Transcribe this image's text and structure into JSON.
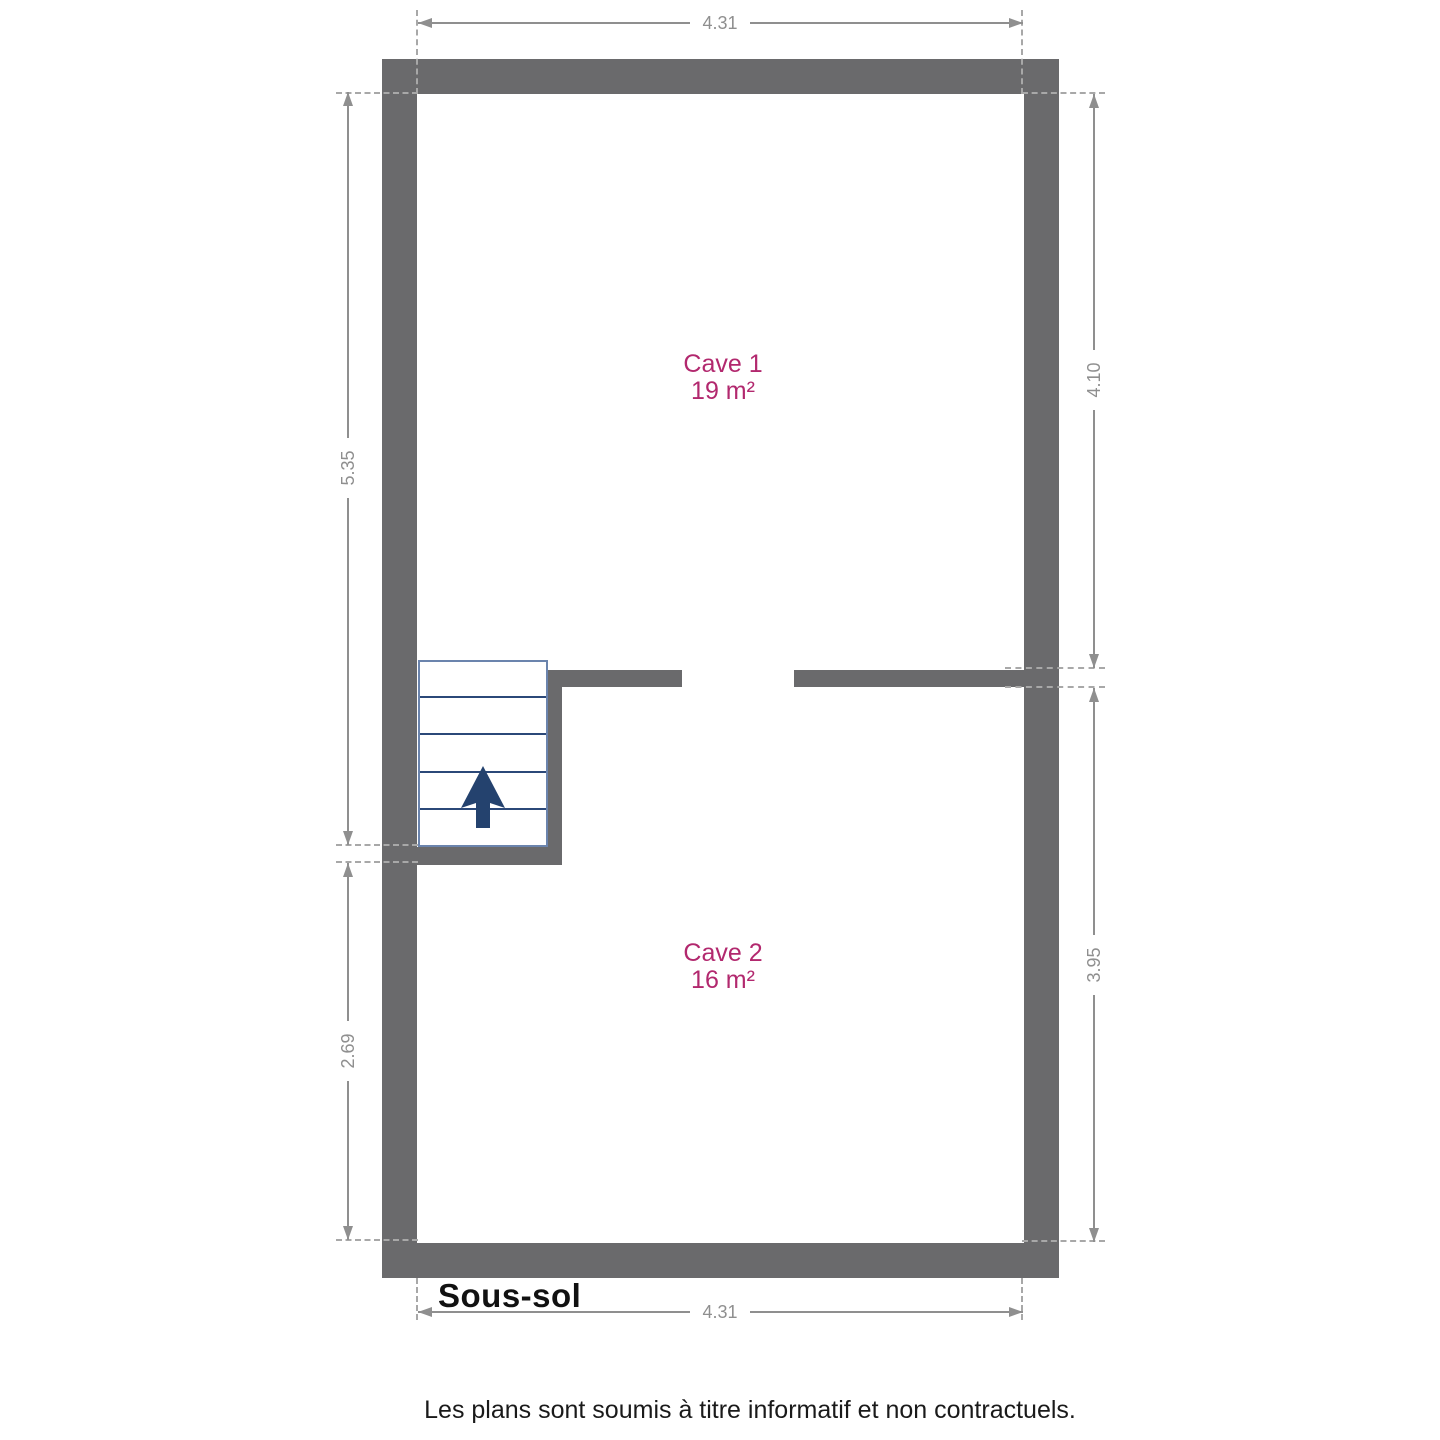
{
  "plan": {
    "title": "Sous-sol",
    "footer_note": "Les plans sont soumis à titre informatif et non contractuels.",
    "rooms": [
      {
        "name": "Cave 1",
        "area": "19 m²"
      },
      {
        "name": "Cave 2",
        "area": "16 m²"
      }
    ],
    "dimensions": {
      "top_width": "4.31",
      "bottom_width": "4.31",
      "left_upper_height": "5.35",
      "left_lower_height": "2.69",
      "right_upper_height": "4.10",
      "right_lower_height": "3.95"
    },
    "icons": {
      "stairs_arrow": "stairs-up-arrow-icon"
    },
    "colors": {
      "wall": "#6a6a6c",
      "dim": "#8f8f8f",
      "dash": "#a8a8a8",
      "room_label": "#b2286e",
      "stairs_fill": "#24426e",
      "stairs_line": "#2b4878",
      "stairs_border": "#6b84ad",
      "title_text": "#111111",
      "footer_text": "#1a1a1a"
    }
  }
}
